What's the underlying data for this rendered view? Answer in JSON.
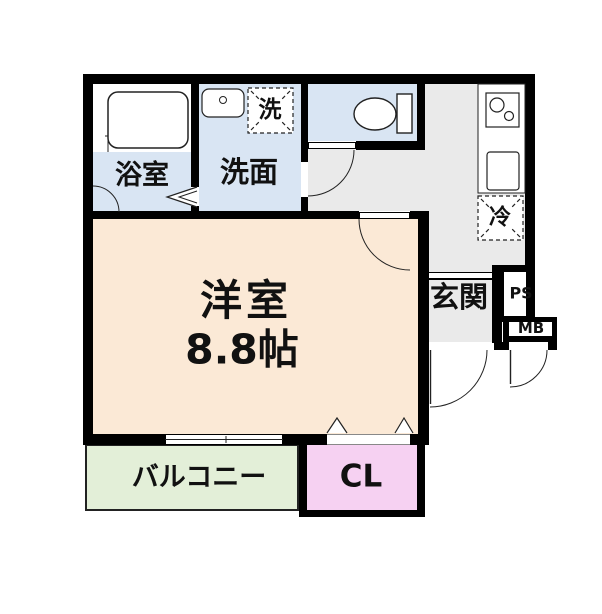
{
  "title": "floor-plan",
  "rooms": {
    "bathroom": "浴室",
    "washroom": "洗面",
    "washing_machine": "洗",
    "main_room_name": "洋室",
    "main_room_size": "8.8帖",
    "entrance": "玄関",
    "refrigerator": "冷",
    "balcony": "バルコニー",
    "closet": "CL",
    "pipe_space": "PS",
    "meter_box": "MB"
  },
  "fixtures": [
    "bathtub",
    "washbasin",
    "toilet",
    "stove-2-burner",
    "kitchen-sink",
    "entrance-door",
    "meter-box-door",
    "toilet-door",
    "room-door",
    "bath-folding-door",
    "closet-folding-door",
    "sliding-window",
    "entrance-step"
  ],
  "colors": {
    "wall": "#000000",
    "wet": "#d9e5f3",
    "living": "#fbe9d6",
    "hall": "#eaeaea",
    "balcony": "#e3efd8",
    "closet": "#f6d1f2",
    "line": "#222222"
  }
}
